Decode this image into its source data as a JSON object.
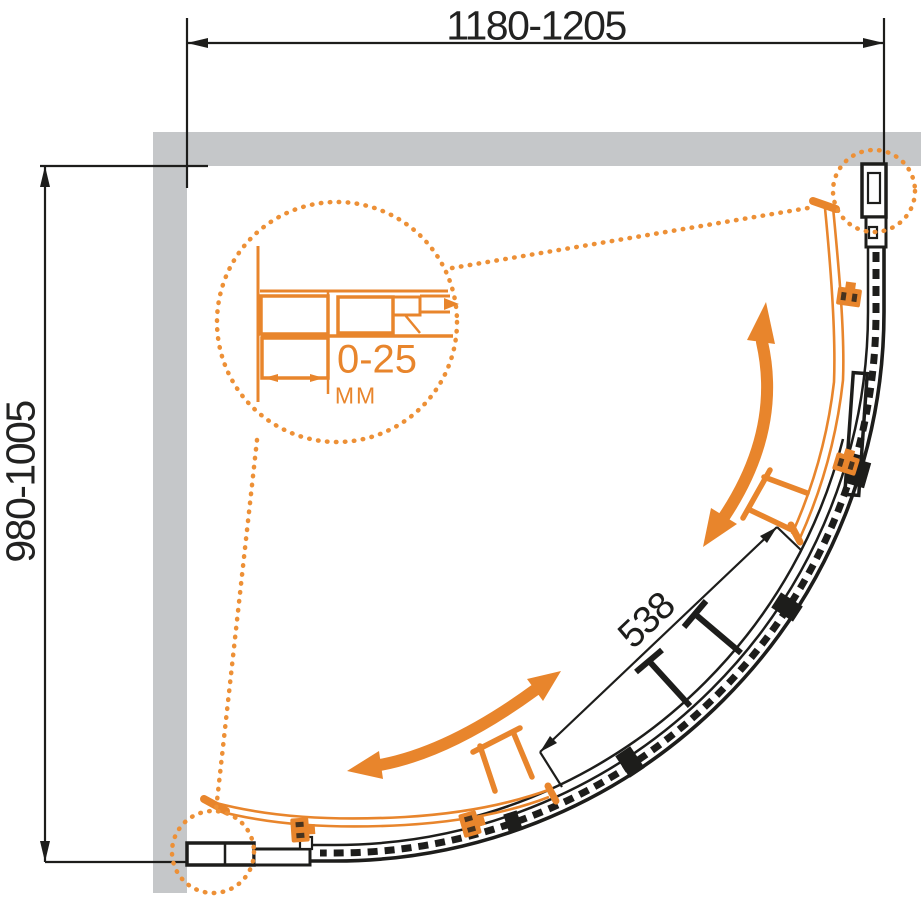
{
  "diagram": {
    "kind": "shower-enclosure-plan-drawing",
    "dimensions": {
      "width_range": "1180-1205",
      "depth_range": "980-1005",
      "door_panel_arc": "538",
      "profile_adjustment_range": "0-25",
      "profile_adjustment_unit": "MM"
    },
    "colors": {
      "accent_orange": "#E8852C",
      "dotted_orange": "#ED9036",
      "line_black": "#1D1D1B",
      "wall_gray": "#C5C7C9",
      "background": "#FFFFFF"
    },
    "icons": {
      "upper_slide_arrow": "curved-double-arrow",
      "lower_slide_arrow": "curved-double-arrow",
      "detail_callout": "dotted-magnifier-circle",
      "corner_callout_top_right": "dotted-circle",
      "corner_callout_bottom_left": "dotted-circle"
    }
  }
}
